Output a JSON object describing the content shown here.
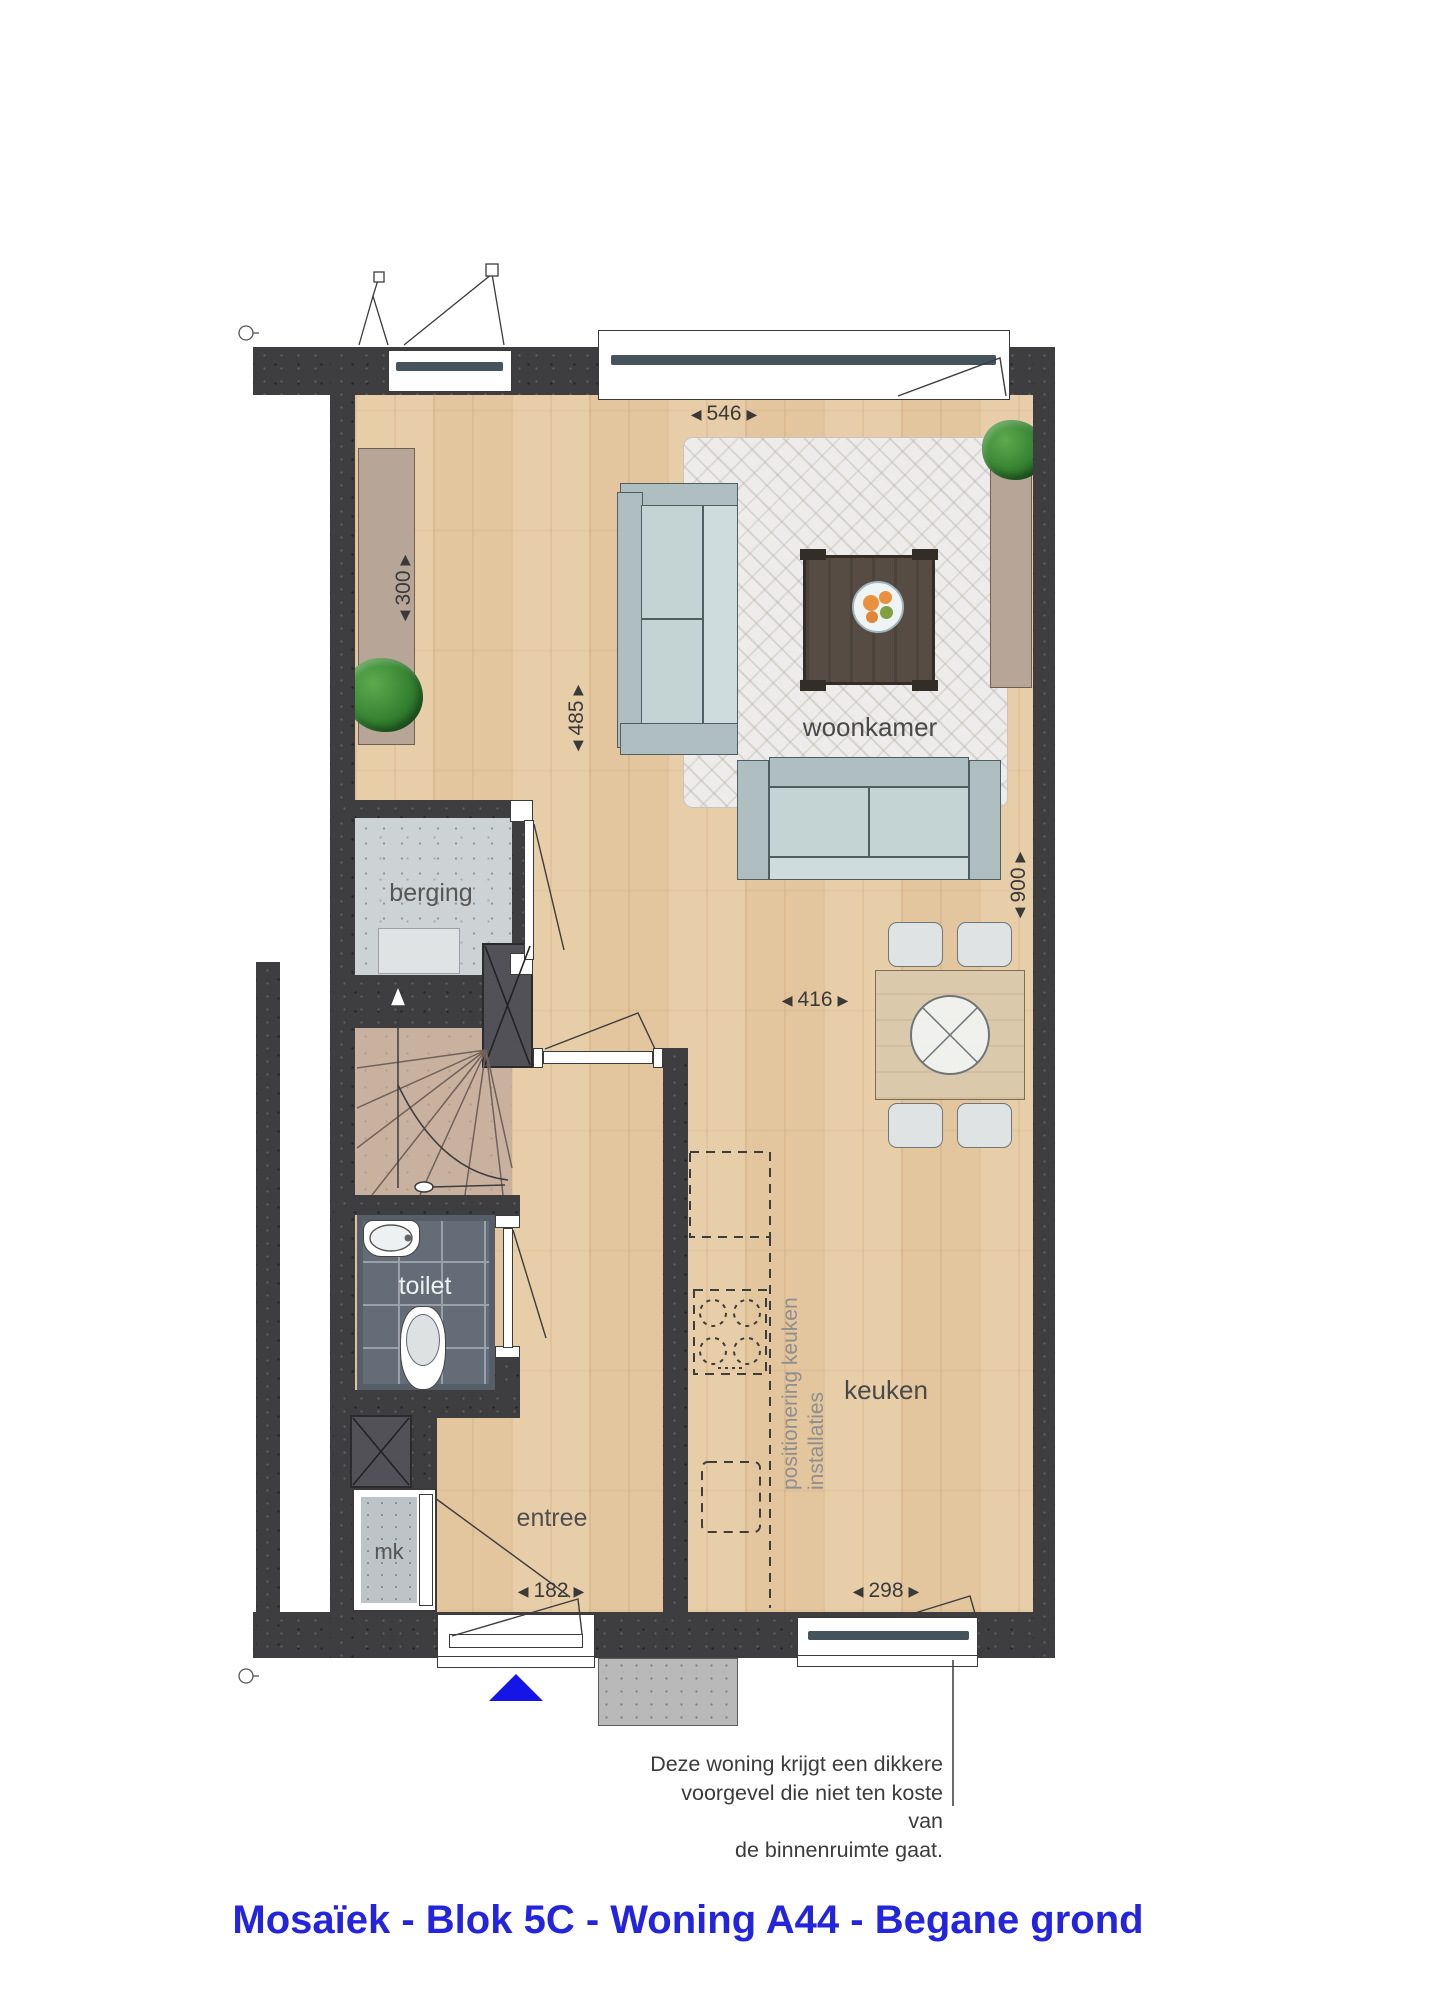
{
  "title": {
    "text": "Mosaïek - Blok 5C - Woning A44 - Begane grond",
    "color": "#2424de"
  },
  "rooms": {
    "woonkamer": {
      "label": "woonkamer"
    },
    "berging": {
      "label": "berging"
    },
    "toilet": {
      "label": "toilet"
    },
    "entree": {
      "label": "entree"
    },
    "keuken": {
      "label": "keuken"
    },
    "meterkast": {
      "label": "mk"
    }
  },
  "dimensions": {
    "arrow_left": "◀",
    "arrow_right": "▶",
    "top_window_width": "546",
    "left_side_depth": "300",
    "living_room_depth": "485",
    "kitchen_width": "416",
    "dining_side_depth": "900",
    "front_door_width": "182",
    "kitchen_window_width": "298"
  },
  "annotations": {
    "kitchen_installation_note": {
      "line1": "positionering keuken",
      "line2": "installaties"
    },
    "facade_note": {
      "line1": "Deze woning krijgt een dikkere",
      "line2": "voorgevel die niet ten koste van",
      "line3": "de binnenruimte gaat."
    }
  },
  "colors": {
    "wall": "#3e3e41",
    "wood_floor": "#e7cba3",
    "berging_concrete": "#cdd2d4",
    "toilet_tiles": "#646d77",
    "stairs": "#c8b19f",
    "rug": "#edecea",
    "sofa": "#b7c7c9",
    "coffee_table": "#564c44",
    "dining_table": "#dbc9ab",
    "entrance_arrow": "#1515e8",
    "title_blue": "#2424de",
    "kitchen_dashes": "#3d3d3d",
    "kitchen_note_gray": "#8f8f8f"
  }
}
